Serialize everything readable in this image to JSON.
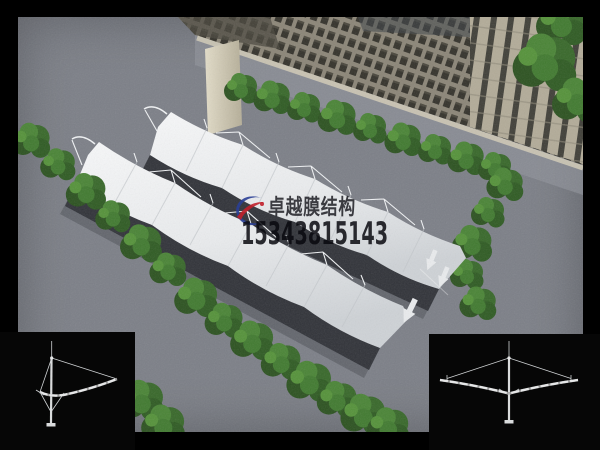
{
  "watermark": {
    "brand_text": "卓越膜结构",
    "phone_number": "15343815143",
    "logo_icon": "crescent-swoosh-logo",
    "logo_blue": "#2a3f96",
    "logo_red": "#c1202b"
  },
  "scene": {
    "palette": {
      "frame_black": "#000000",
      "asphalt_gray": "#7c7f87",
      "membrane_light": "#f6f7f8",
      "membrane_dark": "#cfd3d7",
      "canopy_shadow": "#2a2c32",
      "tree_green_dark": "#2c5220",
      "tree_green_mid": "#3a6b2b",
      "tree_green_light": "#4f8a39",
      "building_facade": "#8b8577",
      "building_window": "#34322b",
      "building_end_wall": "#d8d2bd",
      "diagram_line": "#d6d6d6"
    }
  }
}
